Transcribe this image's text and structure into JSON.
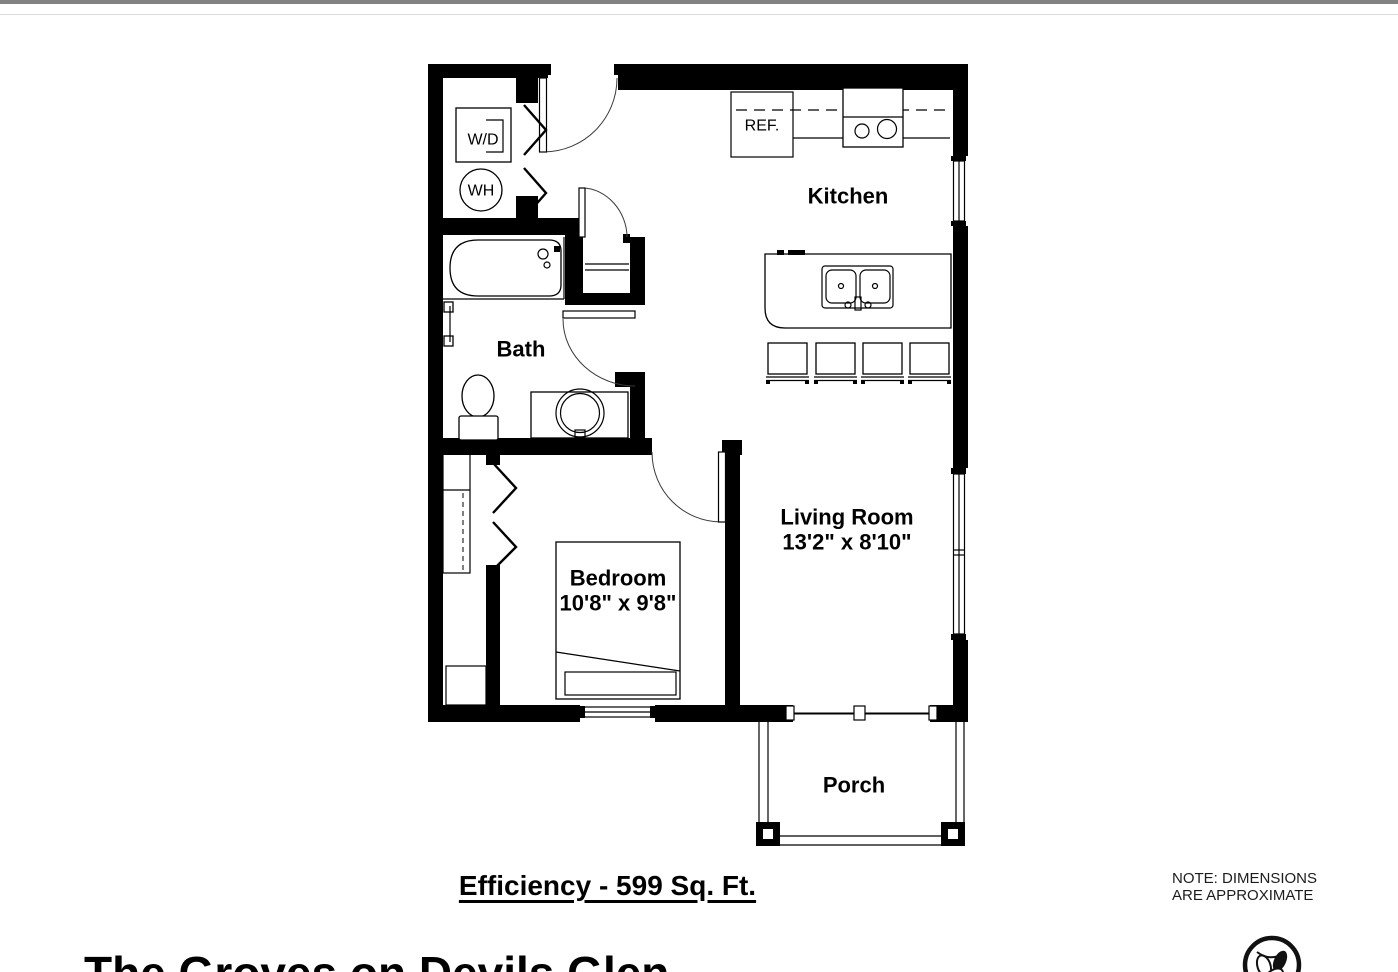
{
  "page": {
    "top_border_color": "#828282"
  },
  "plan": {
    "kitchen_label": "Kitchen",
    "bath_label": "Bath",
    "living_room_label": "Living Room",
    "living_room_dimensions": "13'2\" x 8'10\"",
    "bedroom_label": "Bedroom",
    "bedroom_dimensions": "10'8\" x 9'8\"",
    "porch_label": "Porch",
    "washer_dryer_label": "W/D",
    "water_heater_label": "WH",
    "refrigerator_label": "REF."
  },
  "footer": {
    "plan_title": "Efficiency - 599 Sq. Ft.",
    "property_name": "The Groves on Devils Glen",
    "note_line1": "NOTE: DIMENSIONS",
    "note_line2": "ARE APPROXIMATE"
  },
  "logo": {
    "name": "groves-leaf-logo"
  }
}
